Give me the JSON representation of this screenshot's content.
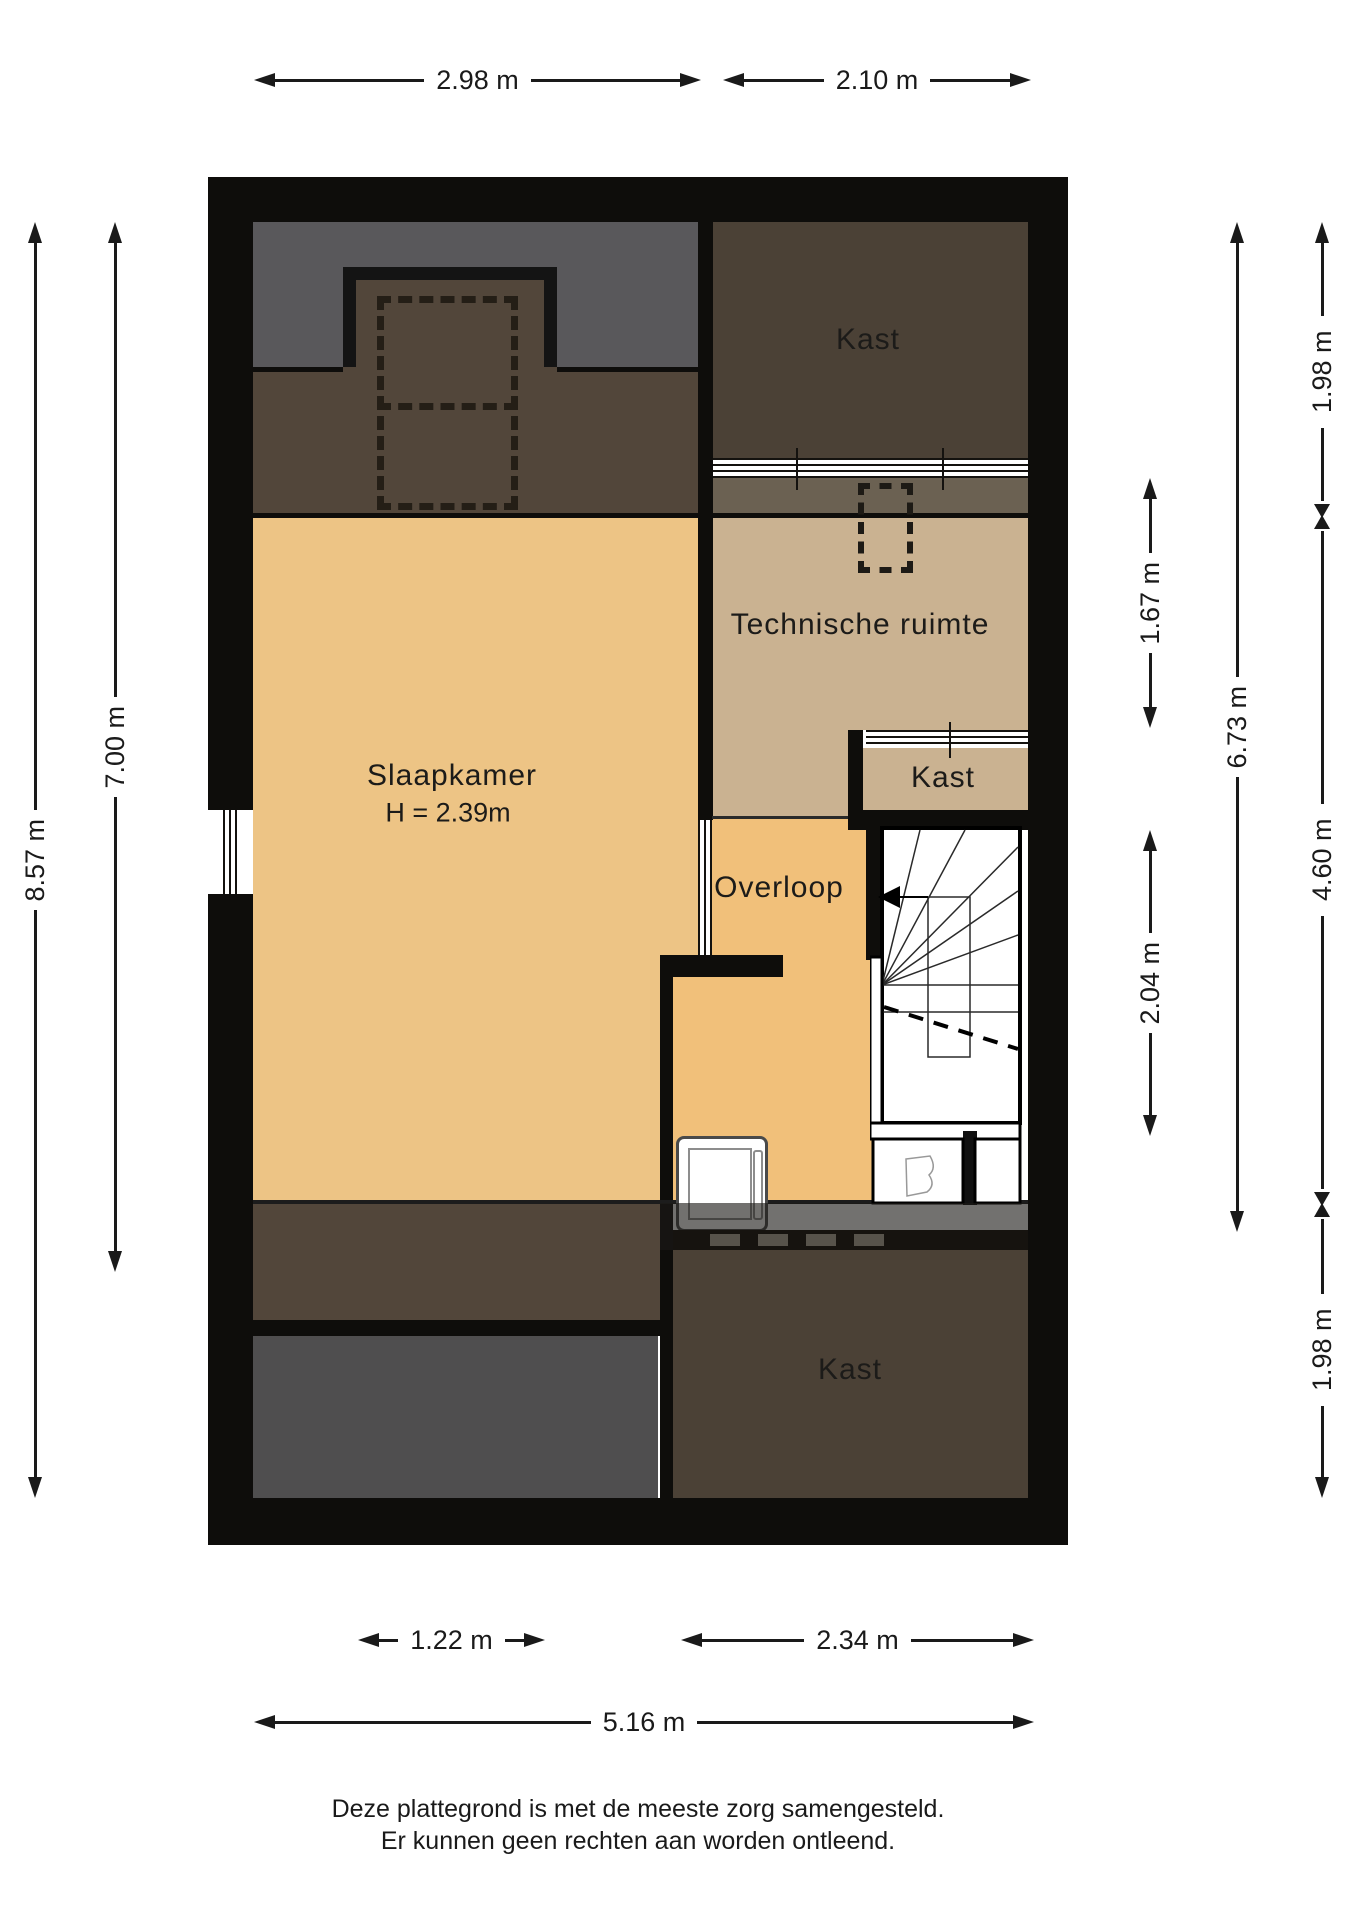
{
  "title": "Plattegrond verdieping",
  "rooms": {
    "slaapkamer": {
      "name": "Slaapkamer",
      "height_note": "H = 2.39m"
    },
    "technische_ruimte": {
      "name": "Technische ruimte"
    },
    "kast_top": {
      "name": "Kast"
    },
    "kast_middle": {
      "name": "Kast"
    },
    "kast_bottom": {
      "name": "Kast"
    },
    "overloop": {
      "name": "Overloop"
    }
  },
  "dimensions": {
    "top": [
      {
        "label": "2.98 m"
      },
      {
        "label": "2.10 m"
      }
    ],
    "bottom": [
      {
        "label": "1.22 m"
      },
      {
        "label": "2.34 m"
      }
    ],
    "bottom_total": {
      "label": "5.16 m"
    },
    "left": [
      {
        "label": "8.57 m"
      },
      {
        "label": "7.00 m"
      }
    ],
    "right_inner": [
      {
        "label": "1.67 m"
      },
      {
        "label": "2.04 m"
      }
    ],
    "right_total": {
      "label": "6.73 m"
    },
    "right_outer": [
      {
        "label": "1.98 m"
      },
      {
        "label": "4.60 m"
      },
      {
        "label": "1.98 m"
      }
    ]
  },
  "footer": {
    "line1": "Deze plattegrond is met de meeste zorg samengesteld.",
    "line2": "Er kunnen geen rechten aan worden ontleend."
  },
  "colors": {
    "wall": "#0e0d0b",
    "gray_top": "#59585b",
    "gray_room": "#4f4e4f",
    "brown": "#52463a",
    "kast": "#4b4136",
    "tan": "#cab291",
    "tan_dark": "#6b6152",
    "yellow": "#edc485",
    "orange": "#f1c07a",
    "dim": "#1a1a1a"
  }
}
